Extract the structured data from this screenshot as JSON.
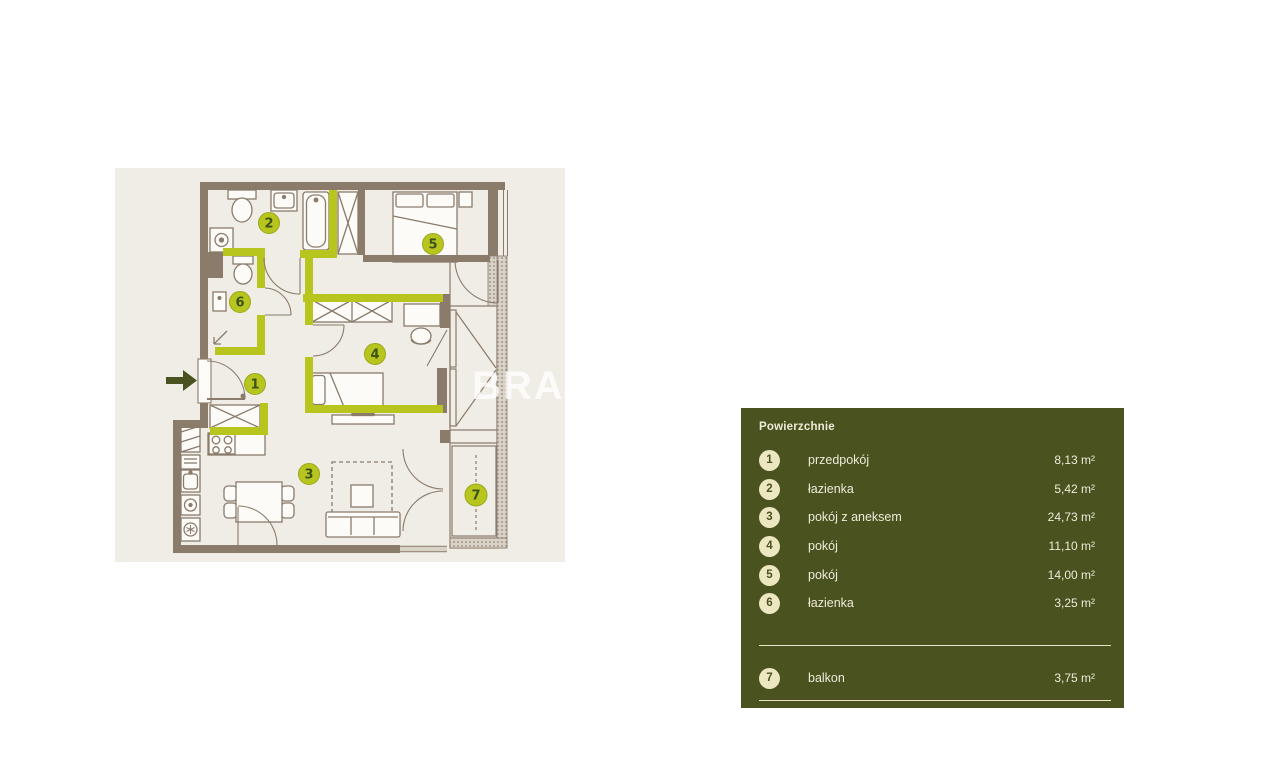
{
  "plan": {
    "watermark": "BRAC",
    "entrance": {
      "icon": "right-arrow"
    },
    "room_numbers": [
      "1",
      "2",
      "3",
      "4",
      "5",
      "6",
      "7"
    ]
  },
  "legend": {
    "title": "Powierzchnie",
    "rows": [
      {
        "number": "1",
        "label": "przedpokój",
        "area": "8,13 m²"
      },
      {
        "number": "2",
        "label": "łazienka",
        "area": "5,42 m²"
      },
      {
        "number": "3",
        "label": "pokój z aneksem",
        "area": "24,73 m²"
      },
      {
        "number": "4",
        "label": "pokój",
        "area": "11,10 m²"
      },
      {
        "number": "5",
        "label": "pokój",
        "area": "14,00 m²"
      },
      {
        "number": "6",
        "label": "łazienka",
        "area": "3,25 m²"
      },
      {
        "number": "7",
        "label": "balkon",
        "area": "3,75 m²"
      }
    ]
  },
  "colors": {
    "page_bg": "#ffffff",
    "plan_bg": "#f0ede6",
    "wall": "#8a7b6b",
    "accent_green": "#b7c51e",
    "circle_number_text": "#3b531b",
    "arrow_dark_olive": "#4a5320",
    "legend_panel_bg": "#4a5320",
    "legend_circle_fill": "#ece7c0",
    "legend_text": "#efead9"
  }
}
